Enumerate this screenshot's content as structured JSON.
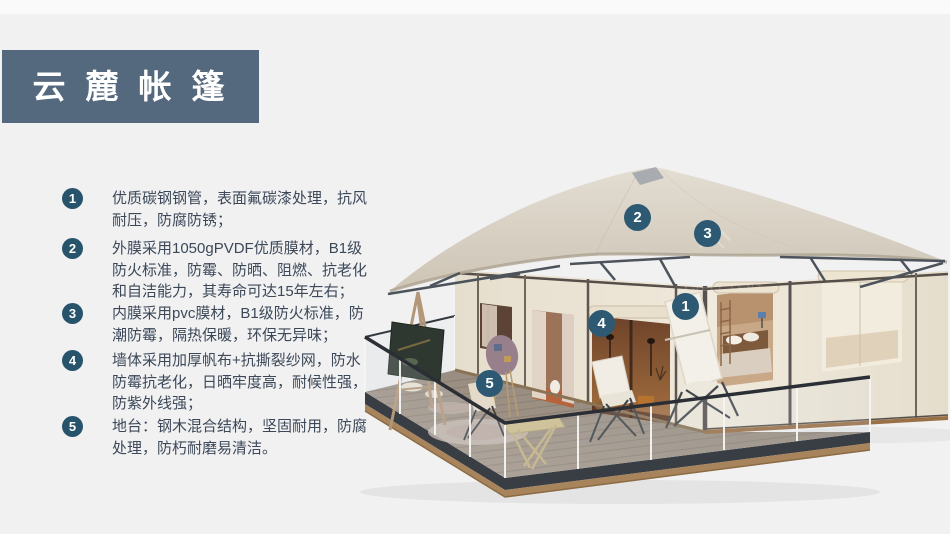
{
  "header": {
    "title": "云麓帐篷"
  },
  "colors": {
    "page_bg": "#F1F1F2",
    "banner_bg": "#54687E",
    "list_badge_bg": "#27536B",
    "callout_badge_bg": "#2D5A72",
    "roof": "#D8D0C3",
    "wall": "#EDE6D7"
  },
  "features": [
    {
      "num": "1",
      "text": "优质碳钢钢管，表面氟碳漆处理，抗风耐压，防腐防锈；"
    },
    {
      "num": "2",
      "text": "外膜采用1050gPVDF优质膜材，B1级防火标准，防霉、防晒、阻燃、抗老化和自洁能力，其寿命可达15年左右；"
    },
    {
      "num": "3",
      "text": "内膜采用pvc膜材，B1级防火标准，防潮防霉，隔热保暖，环保无异味；"
    },
    {
      "num": "4",
      "text": "墙体采用加厚帆布+抗撕裂纱网，防水防霉抗老化，日晒牢度高，耐候性强，防紫外线强；"
    },
    {
      "num": "5",
      "text": "地台：钢木混合结构，坚固耐用，防腐处理，防朽耐磨易清洁。"
    }
  ],
  "image": {
    "callouts": [
      {
        "num": "1"
      },
      {
        "num": "2"
      },
      {
        "num": "3"
      },
      {
        "num": "4"
      },
      {
        "num": "5"
      }
    ],
    "watermark": {
      "cn": "雪利篷房",
      "en": "XUELI TENT",
      "logo": "chevron-tent-logo"
    }
  }
}
